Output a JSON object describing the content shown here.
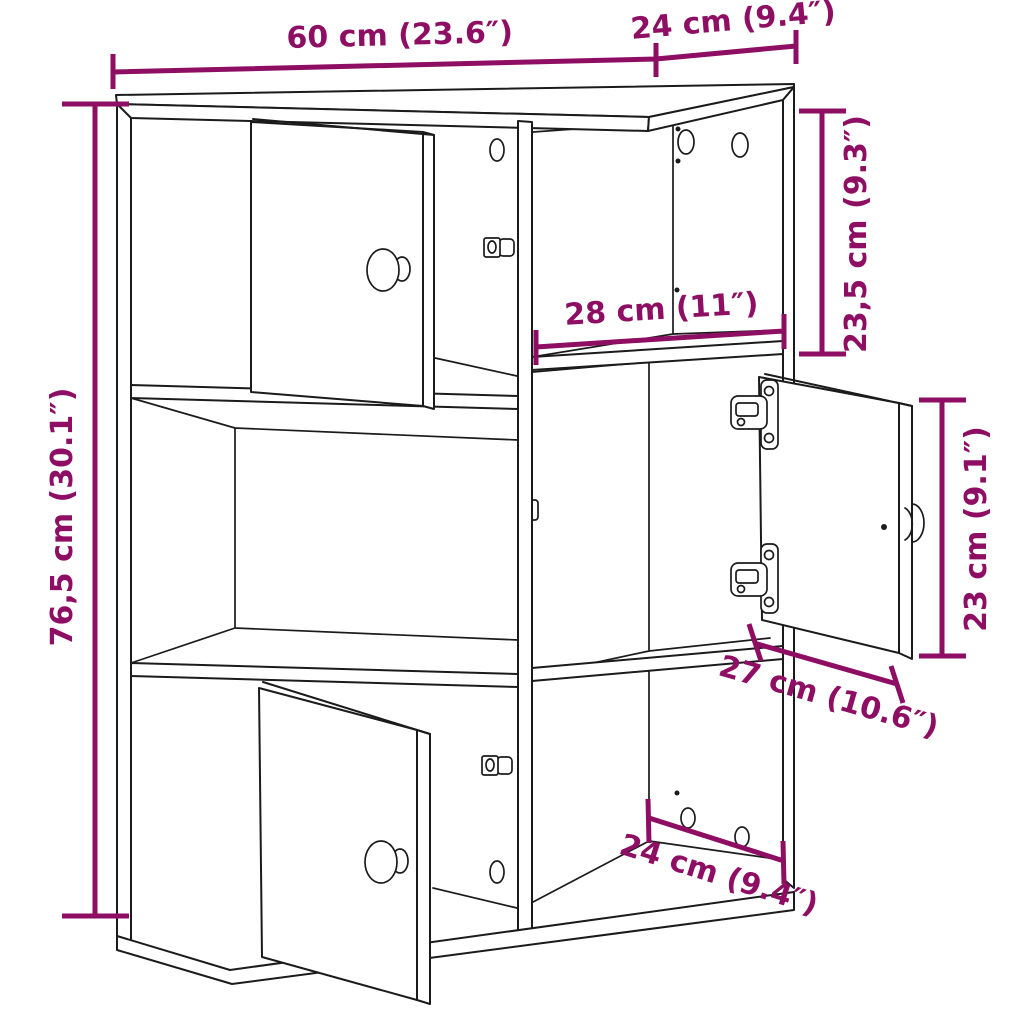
{
  "image": {
    "type": "furniture technical dimension drawing",
    "subject": "bookcase with three open doors, 2x3 compartments"
  },
  "colors": {
    "dimension_accent": "#8E0E63",
    "line": "#1b1b1b",
    "background": "#ffffff"
  },
  "dimensions": {
    "overall_width": "60 cm (23.6″)",
    "overall_depth_top": "24 cm (9.4″)",
    "overall_height": "76,5 cm (30.1″)",
    "top_section_height": "23,5 cm (9.3″)",
    "inner_shelf_width": "28 cm (11″)",
    "door_section_height": "23 cm (9.1″)",
    "inner_shelf_depth": "27 cm (10.6″)",
    "bottom_depth": "24 cm (9.4″)"
  }
}
